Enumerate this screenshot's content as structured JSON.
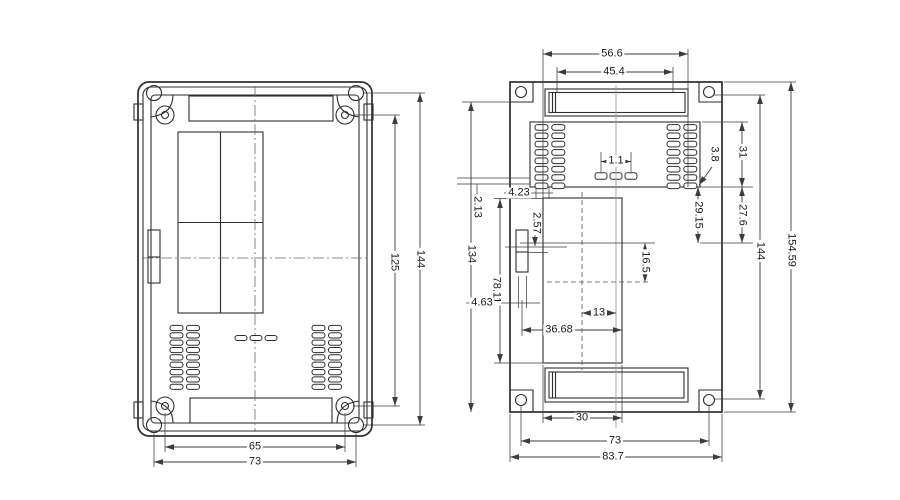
{
  "colors": {
    "line": "#2e2e2e",
    "dimension": "#3c3c3c",
    "background": "#ffffff"
  },
  "left_view": {
    "dims": {
      "slot_width": "65",
      "hole_span": "73",
      "inner_height": "125",
      "outer_height": "144"
    }
  },
  "right_view": {
    "top": {
      "outer_width": "56.6",
      "inner_width": "45.4"
    },
    "pads": {
      "pin_pitch": "1.1",
      "pad_width": "4.23",
      "edge_gap": "2.13",
      "corner_gap": "3.8"
    },
    "left_side": {
      "height": "134",
      "clip_step": "2.57",
      "clip_span": "78.11",
      "clip_width": "4.63"
    },
    "window": {
      "width": "36.68",
      "half_width": "13",
      "offset": "16.5"
    },
    "right_side": {
      "top_section": "31",
      "pad_span": "29.15",
      "mid_section": "27.6",
      "hole_span": "144",
      "total_height": "154.59"
    },
    "bottom": {
      "window_width": "30",
      "hole_span": "73",
      "total_width": "83.7"
    }
  }
}
